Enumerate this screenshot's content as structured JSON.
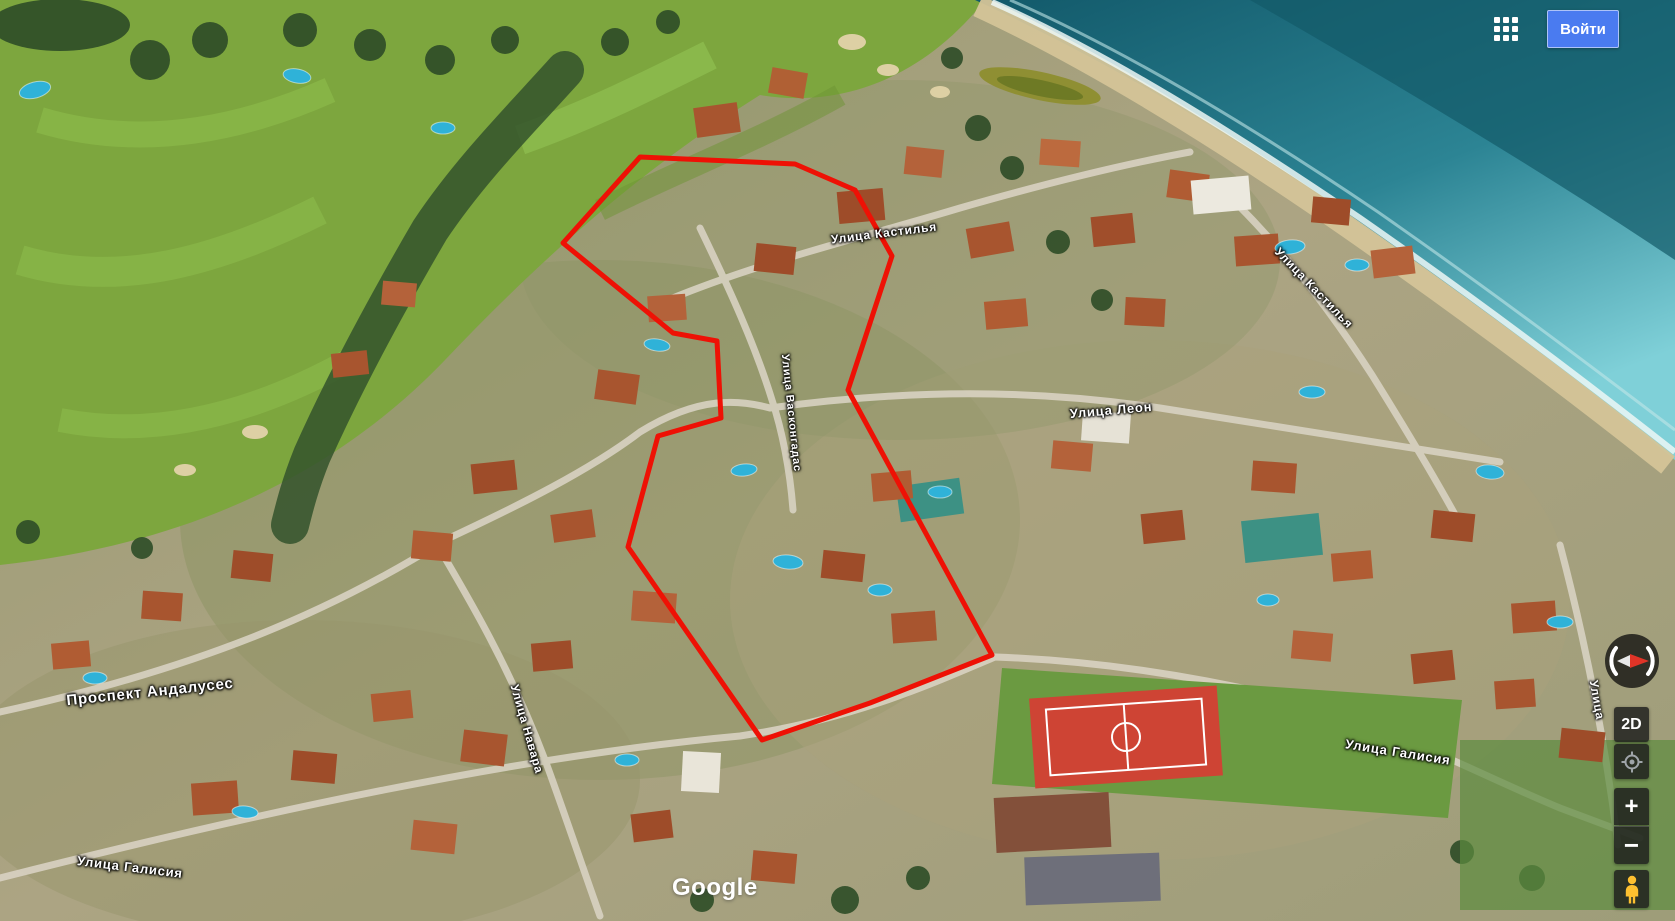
{
  "app": {
    "signin_label": "Войти",
    "logo_text": "Google"
  },
  "controls": {
    "view_toggle_label": "2D",
    "zoom_in_label": "+",
    "zoom_out_label": "−"
  },
  "street_labels": [
    {
      "text": "Проспект Андалусес"
    },
    {
      "text": "Улица Галисия"
    },
    {
      "text": "Улица Навара"
    },
    {
      "text": "Улица Васконгадас"
    },
    {
      "text": "Улица Кастилья"
    },
    {
      "text": "Улица Леон"
    },
    {
      "text": "Улица Кастилья"
    },
    {
      "text": "Улица Галисия"
    },
    {
      "text": "Улица"
    }
  ],
  "overlay": {
    "color": "#ee1105",
    "points": "640,157 795,164 855,190 892,256 848,390 992,655 870,703 762,740 628,547 658,436 721,418 717,341 673,333 563,243"
  },
  "icons": {
    "apps": "apps-grid-icon",
    "compass": "compass-icon",
    "my_location": "my-location-icon",
    "zoom_in": "plus-icon",
    "zoom_out": "minus-icon",
    "pegman": "pegman-icon"
  },
  "colors": {
    "signin_button": "#4a7bf0",
    "selection_outline": "#ee1105",
    "control_background": "rgba(28,28,28,0.82)",
    "pegman_yellow": "#fdc030"
  }
}
